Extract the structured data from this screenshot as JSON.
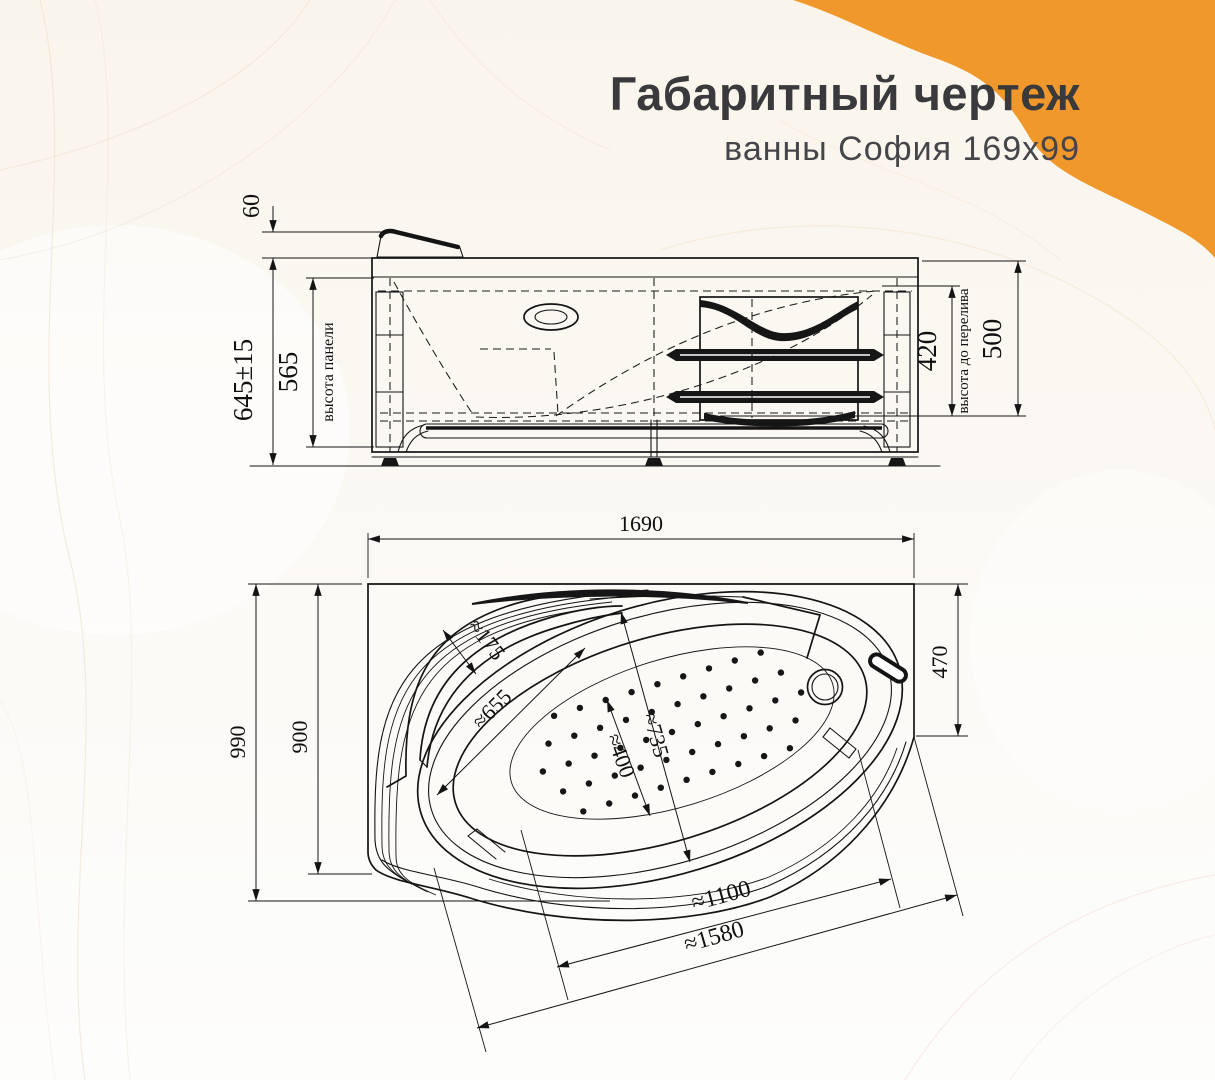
{
  "header": {
    "title": "Габаритный чертеж",
    "subtitle": "ванны София 169x99"
  },
  "side_view": {
    "dims": {
      "headrest_height": "60",
      "overall_height": "645±15",
      "panel_height_value": "565",
      "panel_height_label": "высота панели",
      "overflow_height_value": "420",
      "overflow_height_label": "высота до перелива",
      "rim_to_overflow": "500"
    }
  },
  "plan_view": {
    "dims": {
      "length": "1690",
      "overall_width": "990",
      "body_width": "900",
      "end_width": "470",
      "shelf_width": "≈175",
      "headrest_length": "≈655",
      "bowl_width": "≈735",
      "floor_width": "≈400",
      "bowl_length": "≈1100",
      "inner_length": "≈1580"
    }
  },
  "colors": {
    "accent": "#F0982B",
    "title_text": "#3A3A3C",
    "line": "#141414",
    "background": "#FAF6EE"
  }
}
